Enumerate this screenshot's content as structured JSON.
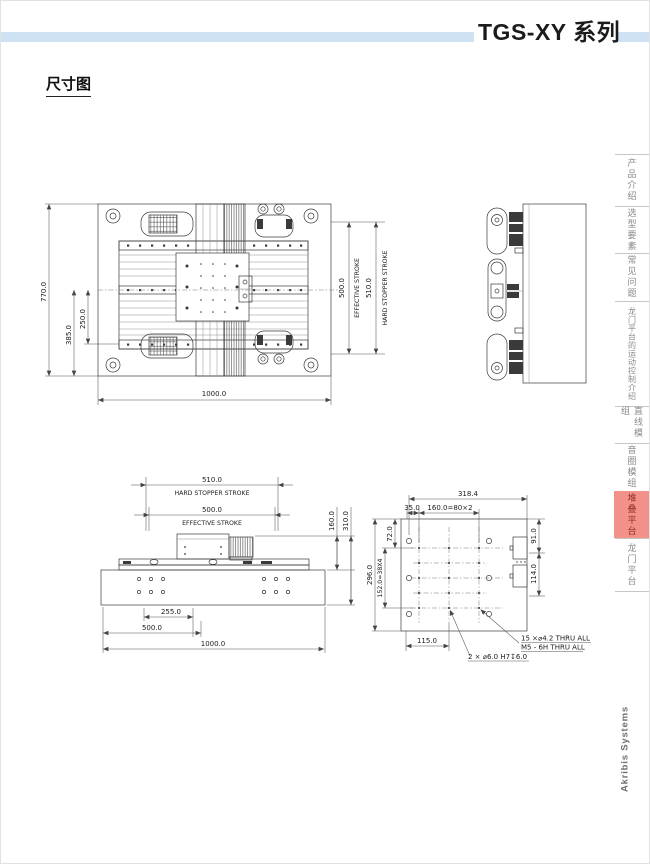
{
  "header": {
    "title": "TGS-XY 系列",
    "accent_bar_color": "#cfe2f4"
  },
  "section_title": "尺寸图",
  "sidebar": {
    "tabs": [
      {
        "label": "产品介绍"
      },
      {
        "label": "选型要素"
      },
      {
        "label": "常见问题"
      },
      {
        "label": "龙门平台的运动控制介绍"
      },
      {
        "label": "直线模组"
      },
      {
        "label": "音圈模组"
      },
      {
        "label": "堆叠平台",
        "active": true
      },
      {
        "label": "龙门平台"
      }
    ],
    "active_tab_bg": "#f29189",
    "active_tab_text": "#8e2d26",
    "brand": "Akribis Systems"
  },
  "drawings": {
    "top_view": {
      "dim_height": "770.0",
      "dim_mid": "385.0",
      "dim_inner": "250.0",
      "dim_width": "1000.0",
      "effective_stroke": {
        "value": "500.0",
        "label": "EFFECTIVE STROKE"
      },
      "hard_stopper": {
        "value": "510.0",
        "label": "HARD STOPPER STROKE"
      }
    },
    "front_view": {
      "hard_stopper": {
        "value": "510.0",
        "label": "HARD STOPPER STROKE"
      },
      "effective_stroke": {
        "value": "500.0",
        "label": "EFFECTIVE STROKE"
      },
      "dim_carriage_height": "160.0",
      "dim_total_height": "310.0",
      "dim_offset": "255.0",
      "dim_half": "500.0",
      "dim_width": "1000.0"
    },
    "plate_view": {
      "dim_width": "318.4",
      "dim_a": "35.0",
      "dim_b": "160.0=80×2",
      "dim_left_a": "72.0",
      "dim_left_b": "152.0=38X4",
      "dim_left_c": "296.0",
      "dim_right_a": "91.0",
      "dim_right_b": "114.0",
      "dim_bottom": "115.0",
      "note_holes_1": "15 ×⌀4.2 THRU ALL",
      "note_holes_2": "M5 - 6H THRU ALL",
      "note_dowel": "2 × ⌀6.0 H7↧6.0"
    }
  }
}
